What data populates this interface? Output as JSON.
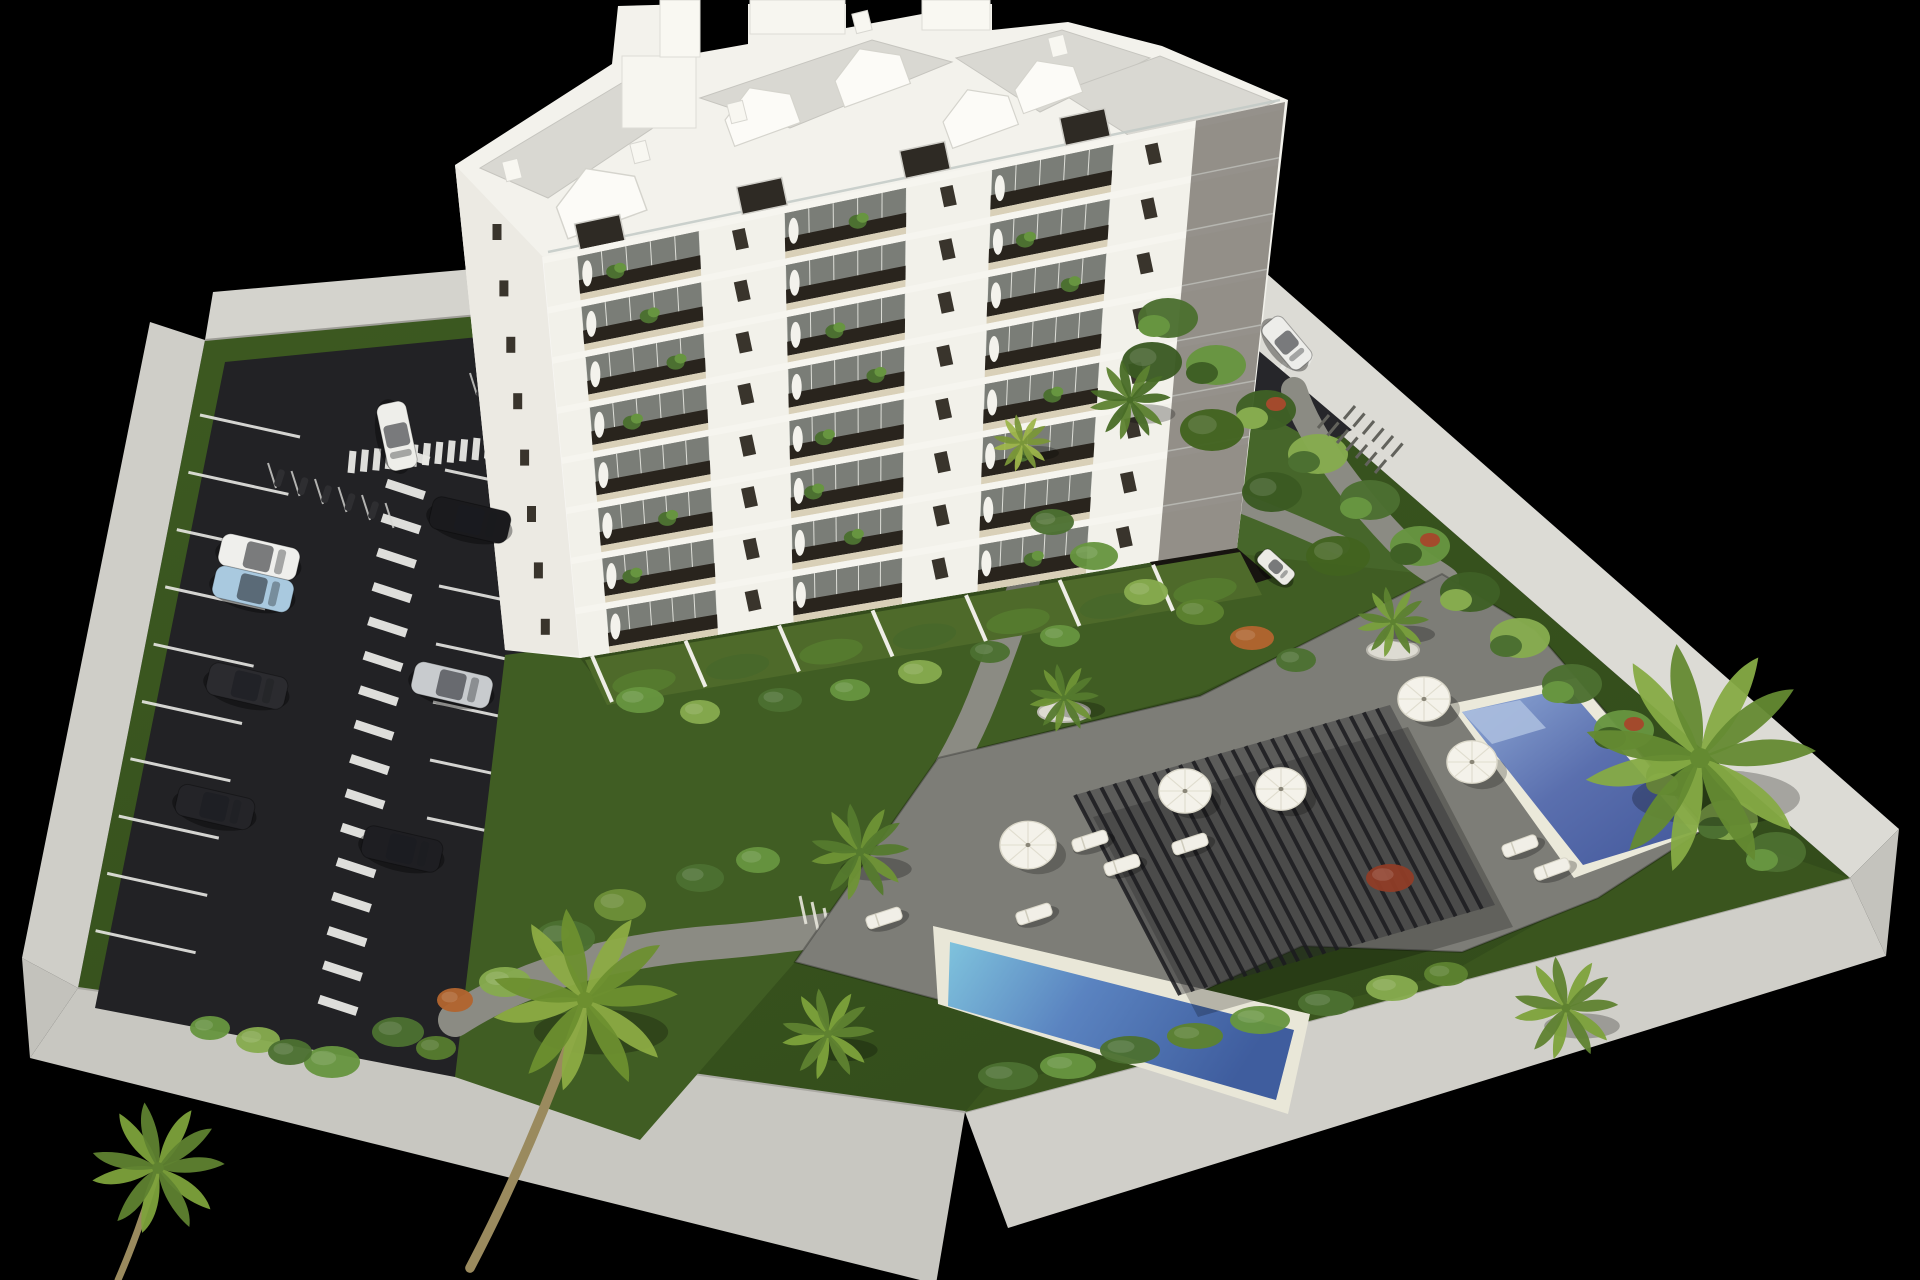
{
  "scene": {
    "type": "3d-architectural-rendering",
    "subject": "aerial-view-residential-complex",
    "background_color": "#000000",
    "elements": [
      "apartment-building",
      "parking-lot",
      "swimming-pools",
      "pergola",
      "gardens",
      "palm-trees",
      "perimeter-wall"
    ]
  },
  "palette": {
    "wall_light": "#d6d5cf",
    "wall_mid": "#c8c7c1",
    "asphalt": "#222225",
    "grass_dark": "#36511d",
    "grass_mid": "#405d23",
    "grass_light": "#46662a",
    "deck": "#7d7d77",
    "path": "#8b8b83",
    "building_white": "#f3f2ec",
    "building_side": "#eceae3",
    "roof_gray": "#d9d8d2",
    "window_dark": "#39342c",
    "opening_dark": "#29241d",
    "balcony_floor": "#d9d0b8",
    "glass": "#cbd6d2",
    "water_deep": "#43589b",
    "water_light": "#7d9ed0",
    "pergola_dark": "#1b1b1f",
    "umbrella_white": "#f4f2ea"
  },
  "building": {
    "floors": 8,
    "balcony_bays": [
      [
        0.045,
        0.21
      ],
      [
        0.325,
        0.49
      ],
      [
        0.605,
        0.77
      ]
    ],
    "wing_range": [
      0.88,
      1.0
    ],
    "wall_window_positions": [
      0.265,
      0.547,
      0.825
    ],
    "facade": {
      "tl": [
        543,
        257
      ],
      "tr": [
        1285,
        102
      ],
      "br": [
        1237,
        548
      ],
      "bl": [
        580,
        658
      ]
    },
    "left_face_windows": {
      "start": [
        497,
        232
      ],
      "step": [
        6.9,
        56.4
      ],
      "count": 8
    },
    "gables": [
      [
        602,
        206,
        1.2
      ],
      [
        763,
        119,
        1.0
      ],
      [
        873,
        80,
        1.0
      ],
      [
        981,
        121,
        1.0
      ],
      [
        1049,
        89,
        0.9
      ]
    ],
    "chimneys": [
      [
        512,
        170
      ],
      [
        640,
        152
      ],
      [
        737,
        112
      ],
      [
        862,
        22
      ],
      [
        1058,
        46
      ]
    ],
    "penthouse_windows": [
      [
        600,
        233
      ],
      [
        762,
        196
      ],
      [
        925,
        160
      ],
      [
        1085,
        127
      ]
    ],
    "penthouse_plants": {
      "start": [
        575,
        262
      ],
      "step": [
        63.9,
        -12.2
      ],
      "count": 10
    }
  },
  "parking": {
    "left_stalls": {
      "start": [
        200,
        415
      ],
      "step": [
        -11.6,
        57.3
      ],
      "count": 10,
      "line": [
        100,
        22
      ]
    },
    "right_stalls": {
      "start": [
        445,
        470
      ],
      "step": [
        -3,
        58
      ],
      "count": 7,
      "line": [
        103,
        22
      ]
    },
    "zebra_walkway": {
      "start": [
        410,
        455
      ],
      "step": [
        -4.5,
        34.4
      ],
      "count": 17,
      "half": [
        19,
        -6.2
      ],
      "width": 9
    },
    "zebra_top": {
      "start": [
        352,
        462
      ],
      "step": [
        12.4,
        -1.3
      ],
      "count": 12,
      "half": [
        1,
        11
      ],
      "width": 7
    },
    "zebra_drive": {
      "start": [
        1266,
        372
      ],
      "step": [
        8.6,
        -2.4
      ],
      "count": 6,
      "half": [
        2.3,
        4.4
      ],
      "width": 5
    },
    "moto_group1": {
      "start": [
        268,
        463
      ],
      "step": [
        23.5,
        8
      ],
      "count": 6,
      "line": [
        8,
        25
      ]
    },
    "moto_group2": {
      "start": [
        470,
        373
      ],
      "step": [
        17.5,
        6.5
      ],
      "count": 4,
      "line": [
        7,
        22
      ]
    }
  },
  "cars": [
    {
      "x": 397,
      "y": 436,
      "rot": 78,
      "len": 68,
      "wid": 30,
      "color": "#eeeeea"
    },
    {
      "x": 259,
      "y": 557,
      "rot": 13,
      "len": 80,
      "wid": 33,
      "color": "#efefec"
    },
    {
      "x": 253,
      "y": 589,
      "rot": 13,
      "len": 80,
      "wid": 33,
      "color": "#a9c9df"
    },
    {
      "x": 247,
      "y": 686,
      "rot": 13,
      "len": 80,
      "wid": 33,
      "color": "#2b2b2f"
    },
    {
      "x": 215,
      "y": 807,
      "rot": 13,
      "len": 78,
      "wid": 32,
      "color": "#242428"
    },
    {
      "x": 470,
      "y": 520,
      "rot": 13,
      "len": 80,
      "wid": 33,
      "color": "#1a1a1d"
    },
    {
      "x": 452,
      "y": 685,
      "rot": 13,
      "len": 80,
      "wid": 33,
      "color": "#c8cbce"
    },
    {
      "x": 402,
      "y": 849,
      "rot": 13,
      "len": 80,
      "wid": 33,
      "color": "#1e1e22"
    },
    {
      "x": 1287,
      "y": 343,
      "rot": 50,
      "len": 56,
      "wid": 26,
      "color": "#ededea"
    },
    {
      "x": 1276,
      "y": 567,
      "rot": 42,
      "len": 40,
      "wid": 18,
      "color": "#ecebe6"
    }
  ],
  "umbrellas": [
    [
      1028,
      845,
      28
    ],
    [
      1185,
      791,
      26
    ],
    [
      1281,
      789,
      25
    ],
    [
      1424,
      699,
      26
    ],
    [
      1472,
      762,
      25
    ]
  ],
  "loungers": [
    [
      884,
      918,
      -18
    ],
    [
      1034,
      914,
      -18
    ],
    [
      1090,
      841,
      -18
    ],
    [
      1122,
      865,
      -18
    ],
    [
      1190,
      844,
      -18
    ],
    [
      1520,
      846,
      -20
    ],
    [
      1552,
      869,
      -20
    ]
  ],
  "palms": [
    {
      "x": 585,
      "y": 1000,
      "s": 1.6,
      "c1": "#8cab43",
      "c2": "#6d8f2f",
      "trunk": [
        470,
        1268
      ]
    },
    {
      "x": 158,
      "y": 1168,
      "s": 1.15,
      "c1": "#7da23b",
      "c2": "#5f8230",
      "trunk": [
        118,
        1280
      ]
    },
    {
      "x": 860,
      "y": 852,
      "s": 0.85,
      "c1": "#6f9436",
      "c2": "#557a2e",
      "trunk": null
    },
    {
      "x": 828,
      "y": 1034,
      "s": 0.8,
      "c1": "#7da23b",
      "c2": "#5f8230",
      "trunk": null
    },
    {
      "x": 1064,
      "y": 698,
      "s": 0.6,
      "c1": "#6f9436",
      "c2": "#557a2e",
      "trunk": null
    },
    {
      "x": 1393,
      "y": 622,
      "s": 0.62,
      "c1": "#79a03c",
      "c2": "#5d8230",
      "trunk": null
    },
    {
      "x": 1700,
      "y": 758,
      "s": 2.0,
      "c1": "#86ab45",
      "c2": "#648a31",
      "trunk": null
    },
    {
      "x": 1566,
      "y": 1008,
      "s": 0.9,
      "c1": "#7da23b",
      "c2": "#5f8230",
      "trunk": null
    },
    {
      "x": 1130,
      "y": 400,
      "s": 0.7,
      "c1": "#5d8230",
      "c2": "#486c26",
      "trunk": null
    },
    {
      "x": 1022,
      "y": 443,
      "s": 0.5,
      "c1": "#9db54a",
      "c2": "#7a9739",
      "trunk": null
    }
  ],
  "planters": [
    [
      1393,
      650
    ],
    [
      1064,
      712
    ]
  ],
  "bushes": [
    [
      620,
      905,
      26,
      16,
      "#6d9038"
    ],
    [
      565,
      938,
      30,
      18,
      "#4c7031"
    ],
    [
      505,
      982,
      26,
      15,
      "#86ab4e"
    ],
    [
      455,
      1000,
      18,
      12,
      "#b2652f"
    ],
    [
      398,
      1032,
      26,
      15,
      "#4c7031"
    ],
    [
      332,
      1062,
      28,
      16,
      "#679540"
    ],
    [
      258,
      1040,
      22,
      13,
      "#86ab4e"
    ],
    [
      700,
      878,
      24,
      14,
      "#4c7031"
    ],
    [
      758,
      860,
      22,
      13,
      "#679540"
    ],
    [
      436,
      1048,
      20,
      12,
      "#567c2f"
    ],
    [
      210,
      1028,
      20,
      12,
      "#679540"
    ],
    [
      290,
      1052,
      22,
      13,
      "#4c7031"
    ],
    [
      1008,
      1076,
      30,
      14,
      "#4c7031"
    ],
    [
      1068,
      1066,
      28,
      13,
      "#679540"
    ],
    [
      1130,
      1050,
      30,
      14,
      "#4c7031"
    ],
    [
      1195,
      1036,
      28,
      13,
      "#5d8230"
    ],
    [
      1260,
      1020,
      30,
      14,
      "#679540"
    ],
    [
      1326,
      1003,
      28,
      13,
      "#4c7031"
    ],
    [
      1392,
      988,
      26,
      13,
      "#86ab4e"
    ],
    [
      1390,
      878,
      24,
      14,
      "#8f3c26"
    ],
    [
      1446,
      974,
      22,
      12,
      "#5d8230"
    ],
    [
      1052,
      522,
      22,
      13,
      "#4c7031"
    ],
    [
      1094,
      556,
      24,
      14,
      "#679540"
    ],
    [
      1146,
      592,
      22,
      13,
      "#86ab4e"
    ],
    [
      1200,
      612,
      24,
      13,
      "#5d8230"
    ],
    [
      1252,
      638,
      22,
      12,
      "#b2652f"
    ],
    [
      1296,
      660,
      20,
      12,
      "#4c7031"
    ],
    [
      1152,
      362,
      30,
      20,
      "#3a5a22"
    ],
    [
      1212,
      430,
      32,
      21,
      "#42631f"
    ],
    [
      1272,
      492,
      30,
      20,
      "#3a5a22"
    ],
    [
      1338,
      556,
      32,
      20,
      "#42631f"
    ],
    [
      640,
      700,
      24,
      13,
      "#679540"
    ],
    [
      700,
      712,
      20,
      12,
      "#86ab4e"
    ],
    [
      780,
      700,
      22,
      12,
      "#4c7031"
    ],
    [
      850,
      690,
      20,
      11,
      "#679540"
    ],
    [
      920,
      672,
      22,
      12,
      "#86ab4e"
    ],
    [
      990,
      652,
      20,
      11,
      "#4c7031"
    ],
    [
      1060,
      636,
      20,
      11,
      "#679540"
    ]
  ],
  "hedge_wall": {
    "points": [
      [
        1168,
        318
      ],
      [
        1216,
        365
      ],
      [
        1266,
        410
      ],
      [
        1318,
        454
      ],
      [
        1370,
        500
      ],
      [
        1420,
        546
      ],
      [
        1470,
        592
      ],
      [
        1520,
        638
      ],
      [
        1572,
        684
      ],
      [
        1624,
        730
      ],
      [
        1676,
        776
      ],
      [
        1728,
        820
      ],
      [
        1776,
        852
      ]
    ],
    "colors": [
      "#4c7031",
      "#679540",
      "#3f6025",
      "#86ab4e"
    ],
    "red_accent_indices": [
      2,
      5,
      9
    ],
    "red_color": "#a34a2c"
  },
  "balcony_plants": [
    [
      0,
      0,
      0.3
    ],
    [
      0,
      1,
      0.6
    ],
    [
      1,
      0,
      0.55
    ],
    [
      1,
      2,
      0.3
    ],
    [
      2,
      1,
      0.4
    ],
    [
      2,
      2,
      0.7
    ],
    [
      3,
      0,
      0.35
    ],
    [
      3,
      1,
      0.75
    ],
    [
      4,
      1,
      0.3
    ],
    [
      4,
      2,
      0.6
    ],
    [
      5,
      0,
      0.6
    ],
    [
      5,
      2,
      0.35
    ],
    [
      6,
      1,
      0.55
    ],
    [
      6,
      0,
      0.25
    ],
    [
      7,
      2,
      0.5
    ],
    [
      2,
      0,
      0.75
    ],
    [
      5,
      1,
      0.2
    ]
  ],
  "terraces": {
    "start": [
      592,
      656
    ],
    "step": [
      93.5,
      -15.2
    ],
    "count": 7,
    "hedge_colors": [
      "#557a2e",
      "#48682a"
    ]
  },
  "pergola": {
    "tl": [
      1075,
      795
    ],
    "tr": [
      1390,
      705
    ],
    "bl": [
      1180,
      995
    ],
    "slats": 24,
    "slat_step": [
      13.125,
      -3.75
    ],
    "slat_vec": [
      105,
      200
    ]
  },
  "bike_racks": {
    "row1": {
      "start": [
        1318,
        428
      ],
      "step": [
        9.5,
        7.5
      ],
      "count": 7
    },
    "row2": {
      "start": [
        1344,
        419
      ],
      "step": [
        9.5,
        7.5
      ],
      "count": 6
    }
  },
  "stairs": {
    "start": [
      800,
      910
    ],
    "step": [
      12,
      6
    ],
    "count": 6
  }
}
